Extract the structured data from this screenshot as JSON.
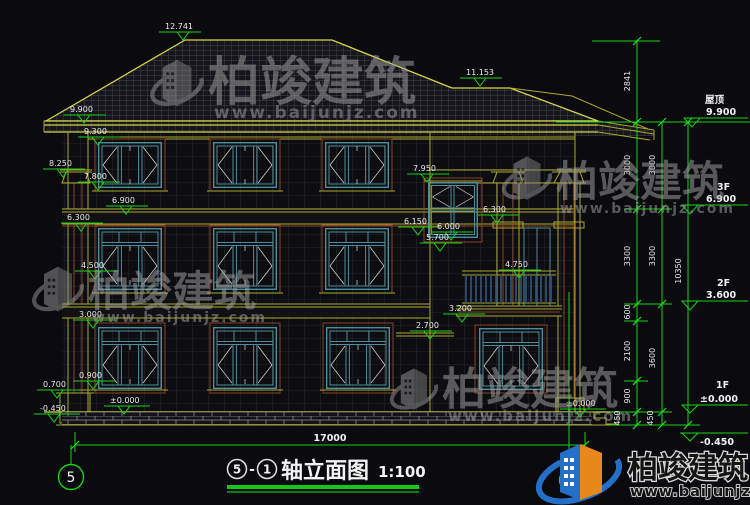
{
  "markers": {
    "ridge": "12.741",
    "subridge": "11.153",
    "eave": "9.900",
    "band93": "9.300",
    "captop": "8.250",
    "capbot": "7.800",
    "f3": "6.900",
    "band63": "6.300",
    "wintop": "7.950",
    "m6150": "6.150",
    "m6000": "6.000",
    "m5700": "5.700",
    "ledge63": "6.300",
    "rail": "4.750",
    "balc": "3.200",
    "awn": "2.700",
    "m45": "4.500",
    "m30": "3.000",
    "sill": "0.900",
    "base": "0.700",
    "zeroL": "±0.000",
    "zeroR": "±0.000",
    "minus": "-0.450"
  },
  "floors": {
    "roof_name": "屋顶",
    "roof_val": "9.900",
    "f3_name": "3F",
    "f3_val": "6.900",
    "f2_name": "2F",
    "f2_val": "3.600",
    "f1_name": "1F",
    "f1_val": "±0.000",
    "below_val": "-0.450"
  },
  "dims": {
    "a": [
      "2841",
      "3000",
      "3300",
      "600",
      "2100",
      "900",
      "450"
    ],
    "b": [
      "3000",
      "3300",
      "3600",
      "450"
    ],
    "total": "10350",
    "width": "17000"
  },
  "title": {
    "n1": "5",
    "dash": "-",
    "n2": "1",
    "text": "轴立面图",
    "scale": "1:100"
  },
  "axes": {
    "left": "5",
    "right": "1"
  },
  "brand": {
    "name": "柏竣建筑",
    "url": "www.baijunjz.com"
  }
}
